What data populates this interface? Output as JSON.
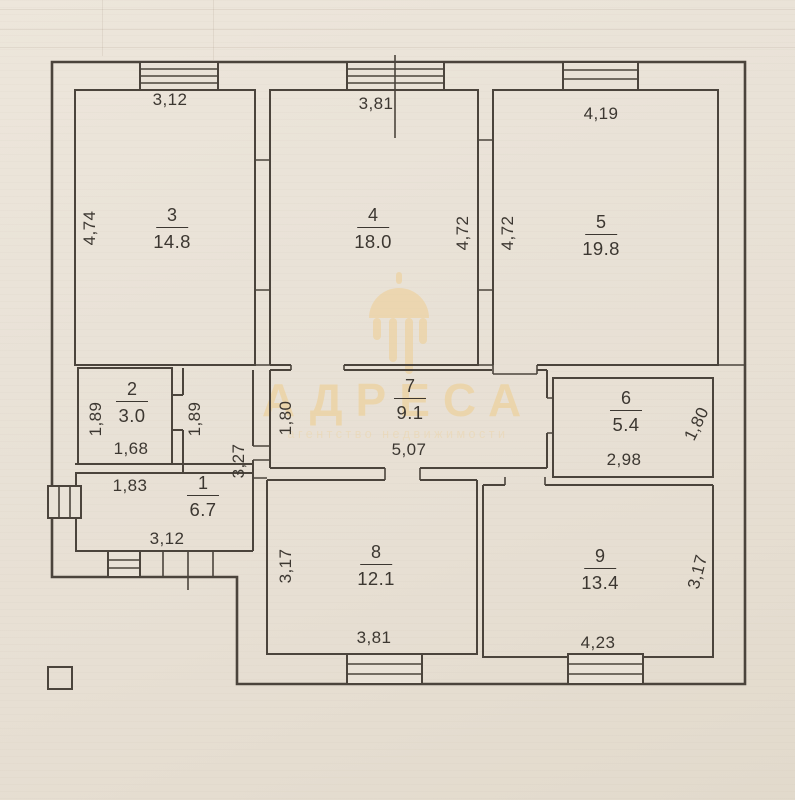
{
  "watermark": {
    "title": "АДРЕСА",
    "subtitle": "агентство недвижимости",
    "logo": "chandelier-logo"
  },
  "colors": {
    "paper": "#e9e2d7",
    "ink": "#4b443c",
    "watermark_gold": "#efcd8c"
  },
  "rooms": [
    {
      "number": "1",
      "area": "6.7",
      "dim_top": "1,83",
      "dim_right": "3,27",
      "dim_bottom": "3,12"
    },
    {
      "number": "2",
      "area": "3.0",
      "dim_left": "1,89",
      "dim_right": "1,89",
      "dim_bottom": "1,68"
    },
    {
      "number": "3",
      "area": "14.8",
      "dim_top": "3,12",
      "dim_left": "4,74"
    },
    {
      "number": "4",
      "area": "18.0",
      "dim_top": "3,81",
      "dim_right": "4,72"
    },
    {
      "number": "5",
      "area": "19.8",
      "dim_top": "4,19",
      "dim_left": "4,72"
    },
    {
      "number": "6",
      "area": "5.4",
      "dim_bottom": "2,98",
      "dim_right": "1,80"
    },
    {
      "number": "7",
      "area": "9.1",
      "dim_left": "1,80",
      "dim_bottom": "5,07"
    },
    {
      "number": "8",
      "area": "12.1",
      "dim_left": "3,17",
      "dim_bottom": "3,81"
    },
    {
      "number": "9",
      "area": "13.4",
      "dim_bottom": "4,23",
      "dim_right": "3,17"
    }
  ]
}
